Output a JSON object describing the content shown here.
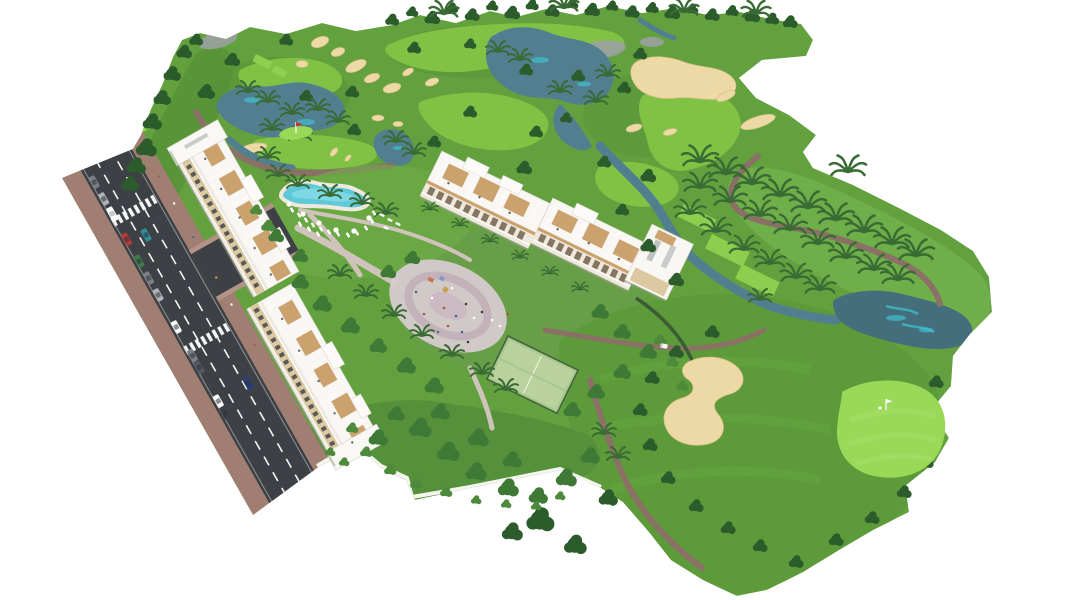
{
  "meta": {
    "title": "Aerial 3D render - golf resort residential development",
    "canvas": {
      "width": 1068,
      "height": 600
    },
    "background": "#ffffff"
  },
  "scene": {
    "setting": "Isometric aerial architectural rendering of a white low-rise apartment complex beside a golf course, on a plain white background",
    "road": {
      "orientation": "diagonal from upper-left down to bottom-centre",
      "features": [
        "dark asphalt with dashed white lane lines",
        "two zebra crosswalks",
        "side street entering the complex",
        "red-brown sidewalks",
        "parked cars along the kerb"
      ],
      "parked_cars": 12,
      "moving_cars": 2
    },
    "buildings": {
      "count": 2,
      "style": "long staggered white 4-5 storey blocks with cream balcony bands, wooden roof decks, penthouse volumes and end towers",
      "left_block": "runs parallel to the road",
      "middle_block": "runs diagonally across the centre, taller tower at its east end"
    },
    "amenities": [
      "lagoon-shaped swimming pool with sun loungers and parasols",
      "oval paved plaza and playground with people",
      "two padel courts with dark green fencing",
      "walled private gardens with dense trees"
    ],
    "golf_course": {
      "fairways": "bright green ribbons over darker rough",
      "bunkers": 20,
      "lakes": 6,
      "greens_with_flag": 2,
      "tee_pads": 5,
      "cart_paths": "brown winding ribbons",
      "golf_cart": 1,
      "golfer": 1
    },
    "vegetation": {
      "round_trees": "dark green clustered canopies along edges and gardens",
      "palm_trees": "arc of tall palms along the eastern slope and around lakes"
    }
  },
  "palette": {
    "background": "#ffffff",
    "terrain": "#63a03e",
    "rough": "#549138",
    "sage": "#6d9c4f",
    "slope": "#6fb04a",
    "fairway": "#82c444",
    "fairwayBright": "#90d150",
    "puttingGreen": "#9ad858",
    "lowerFairway": "#5c9a3a",
    "gardenLawn": "#55913a",
    "resortLawn": "#6fae4a",
    "sand": "#ecd9a6",
    "sandEdge": "#d9c086",
    "lake": "#527f90",
    "lakeDark": "#456e7c",
    "lakeTeal": "#3fc5d4",
    "rock": "#9ba1a1",
    "cartPath": "#8b7066",
    "resortPath": "#cfc3bb",
    "roadAsphalt": "#3d4045",
    "roadMarking": "#f5f5f5",
    "sidewalk": "#a07e72",
    "sidewalkLight": "#b59287",
    "buildingWhite": "#f8f7f4",
    "buildingShade": "#eeeae1",
    "facadeCream": "#dcc9a2",
    "woodDeck": "#c89a62",
    "windowDark": "#41464c",
    "arcadeDark": "#6b5a44",
    "wallWhite": "#f6f4ef",
    "treeDark": "#2d5c2c",
    "treeMid": "#3e7a36",
    "treeLight": "#4e8a3c",
    "palmGreen": "#3a6b35",
    "poolWater": "#5fc9d9",
    "poolLight": "#8adde8",
    "poolDeck": "#efe9dd",
    "plaza": "#d7cbd0",
    "plazaRing": "#c3b2ba",
    "courtGreen": "#a9c78e",
    "courtLight": "#b9d29e",
    "fenceGreen": "#44663f",
    "hedgeDark": "#3d5c35",
    "flagRed": "#cc3333",
    "carRed": "#b03a3a",
    "carTeal": "#2e8f9a",
    "carGreen": "#3f7a4a",
    "carGray": "#7b8086",
    "carSilver": "#aeb3b8",
    "carWhite": "#ffffff",
    "carNavy": "#2a3f7a",
    "buildingShadow": "#99a08d"
  }
}
